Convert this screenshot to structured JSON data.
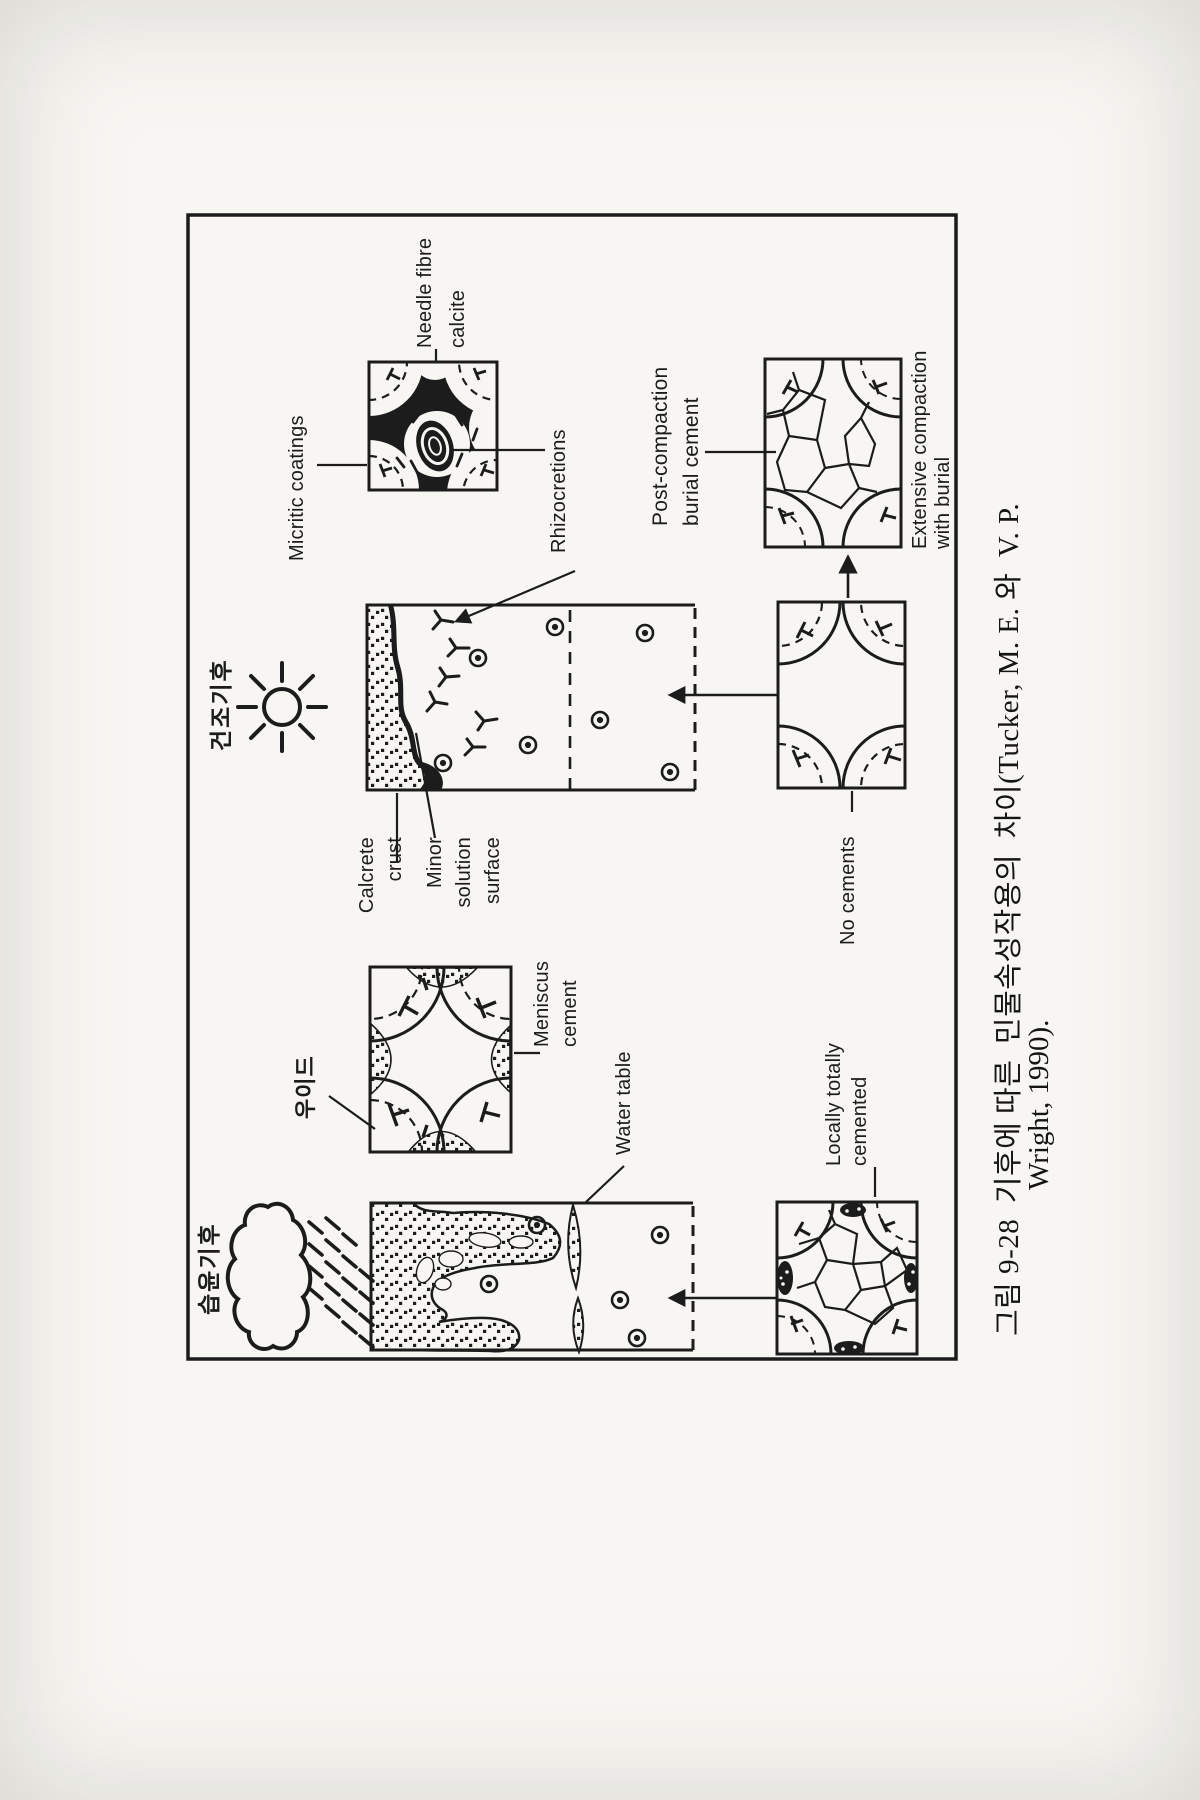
{
  "colors": {
    "ink": "#1c1c1c",
    "paper": "#f7f6f2"
  },
  "labels": {
    "humid_climate": "습윤기후",
    "dry_climate": "건조기후",
    "ooid": "우이드",
    "micritic_coatings": "Micritic coatings",
    "needle_fibre": "Needle fibre\ncalcite",
    "rhizocretions": "Rhizocretions",
    "calcrete_crust": "Calcrete\ncrust",
    "minor_solution_surface": "Minor\nsolution\nsurface",
    "meniscus_cement": "Meniscus\ncement",
    "water_table": "Water table",
    "no_cements": "No cements",
    "locally_totally_cemented": "Locally totally\ncemented",
    "post_compaction_burial_cement": "Post-compaction\nburial cement",
    "extensive_compaction_with_burial": "Extensive compaction\nwith burial"
  },
  "caption": {
    "line1": "그림 9-28  기후에 따른  민물속성작용의  차이(Tucker, M. E. 와  V. P.",
    "line2": "Wright, 1990)."
  },
  "icons": {
    "sun": "sun-icon",
    "rain_cloud": "rain-cloud-icon",
    "rain": "rain-icon"
  }
}
